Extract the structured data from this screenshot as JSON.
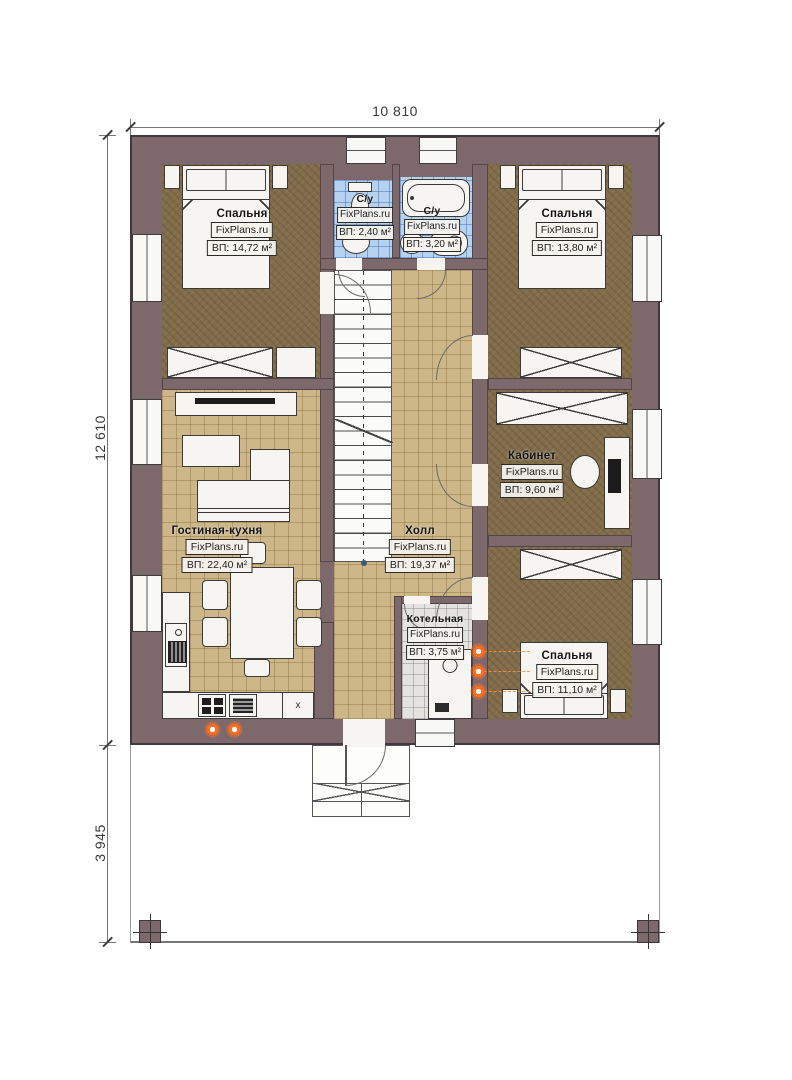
{
  "dimensions": {
    "top_width": "10 810",
    "left_height_main": "12 610",
    "left_height_porch": "3 945"
  },
  "rooms": [
    {
      "key": "bedroom-top-left",
      "name": "Спальня",
      "brand": "FixPlans.ru",
      "area": "ВП: 14,72 м²"
    },
    {
      "key": "bathroom-left",
      "name": "С/у",
      "brand": "FixPlans.ru",
      "area": "ВП: 2,40 м²"
    },
    {
      "key": "bathroom-right",
      "name": "С/у",
      "brand": "FixPlans.ru",
      "area": "ВП: 3,20 м²"
    },
    {
      "key": "bedroom-top-right",
      "name": "Спальня",
      "brand": "FixPlans.ru",
      "area": "ВП: 13,80 м²"
    },
    {
      "key": "office",
      "name": "Кабинет",
      "brand": "FixPlans.ru",
      "area": "ВП: 9,60 м²"
    },
    {
      "key": "living-kitchen",
      "name": "Гостиная-кухня",
      "brand": "FixPlans.ru",
      "area": "ВП: 22,40 м²"
    },
    {
      "key": "hall",
      "name": "Холл",
      "brand": "FixPlans.ru",
      "area": "ВП: 19,37 м²"
    },
    {
      "key": "boiler",
      "name": "Котельная",
      "brand": "FixPlans.ru",
      "area": "ВП: 3,75 м²"
    },
    {
      "key": "bedroom-bottom",
      "name": "Спальня",
      "brand": "FixPlans.ru",
      "area": "ВП: 11,10 м²"
    }
  ],
  "symbols": {
    "cabinet_mark": "x"
  },
  "colors": {
    "wall": "#7d696c",
    "wood_floor": "#826d4b",
    "tile_tan": "#cdb688",
    "tile_blue": "#b5d2f1",
    "tile_gray": "#e4e3df",
    "heat_orange": "#ff6d1f"
  }
}
